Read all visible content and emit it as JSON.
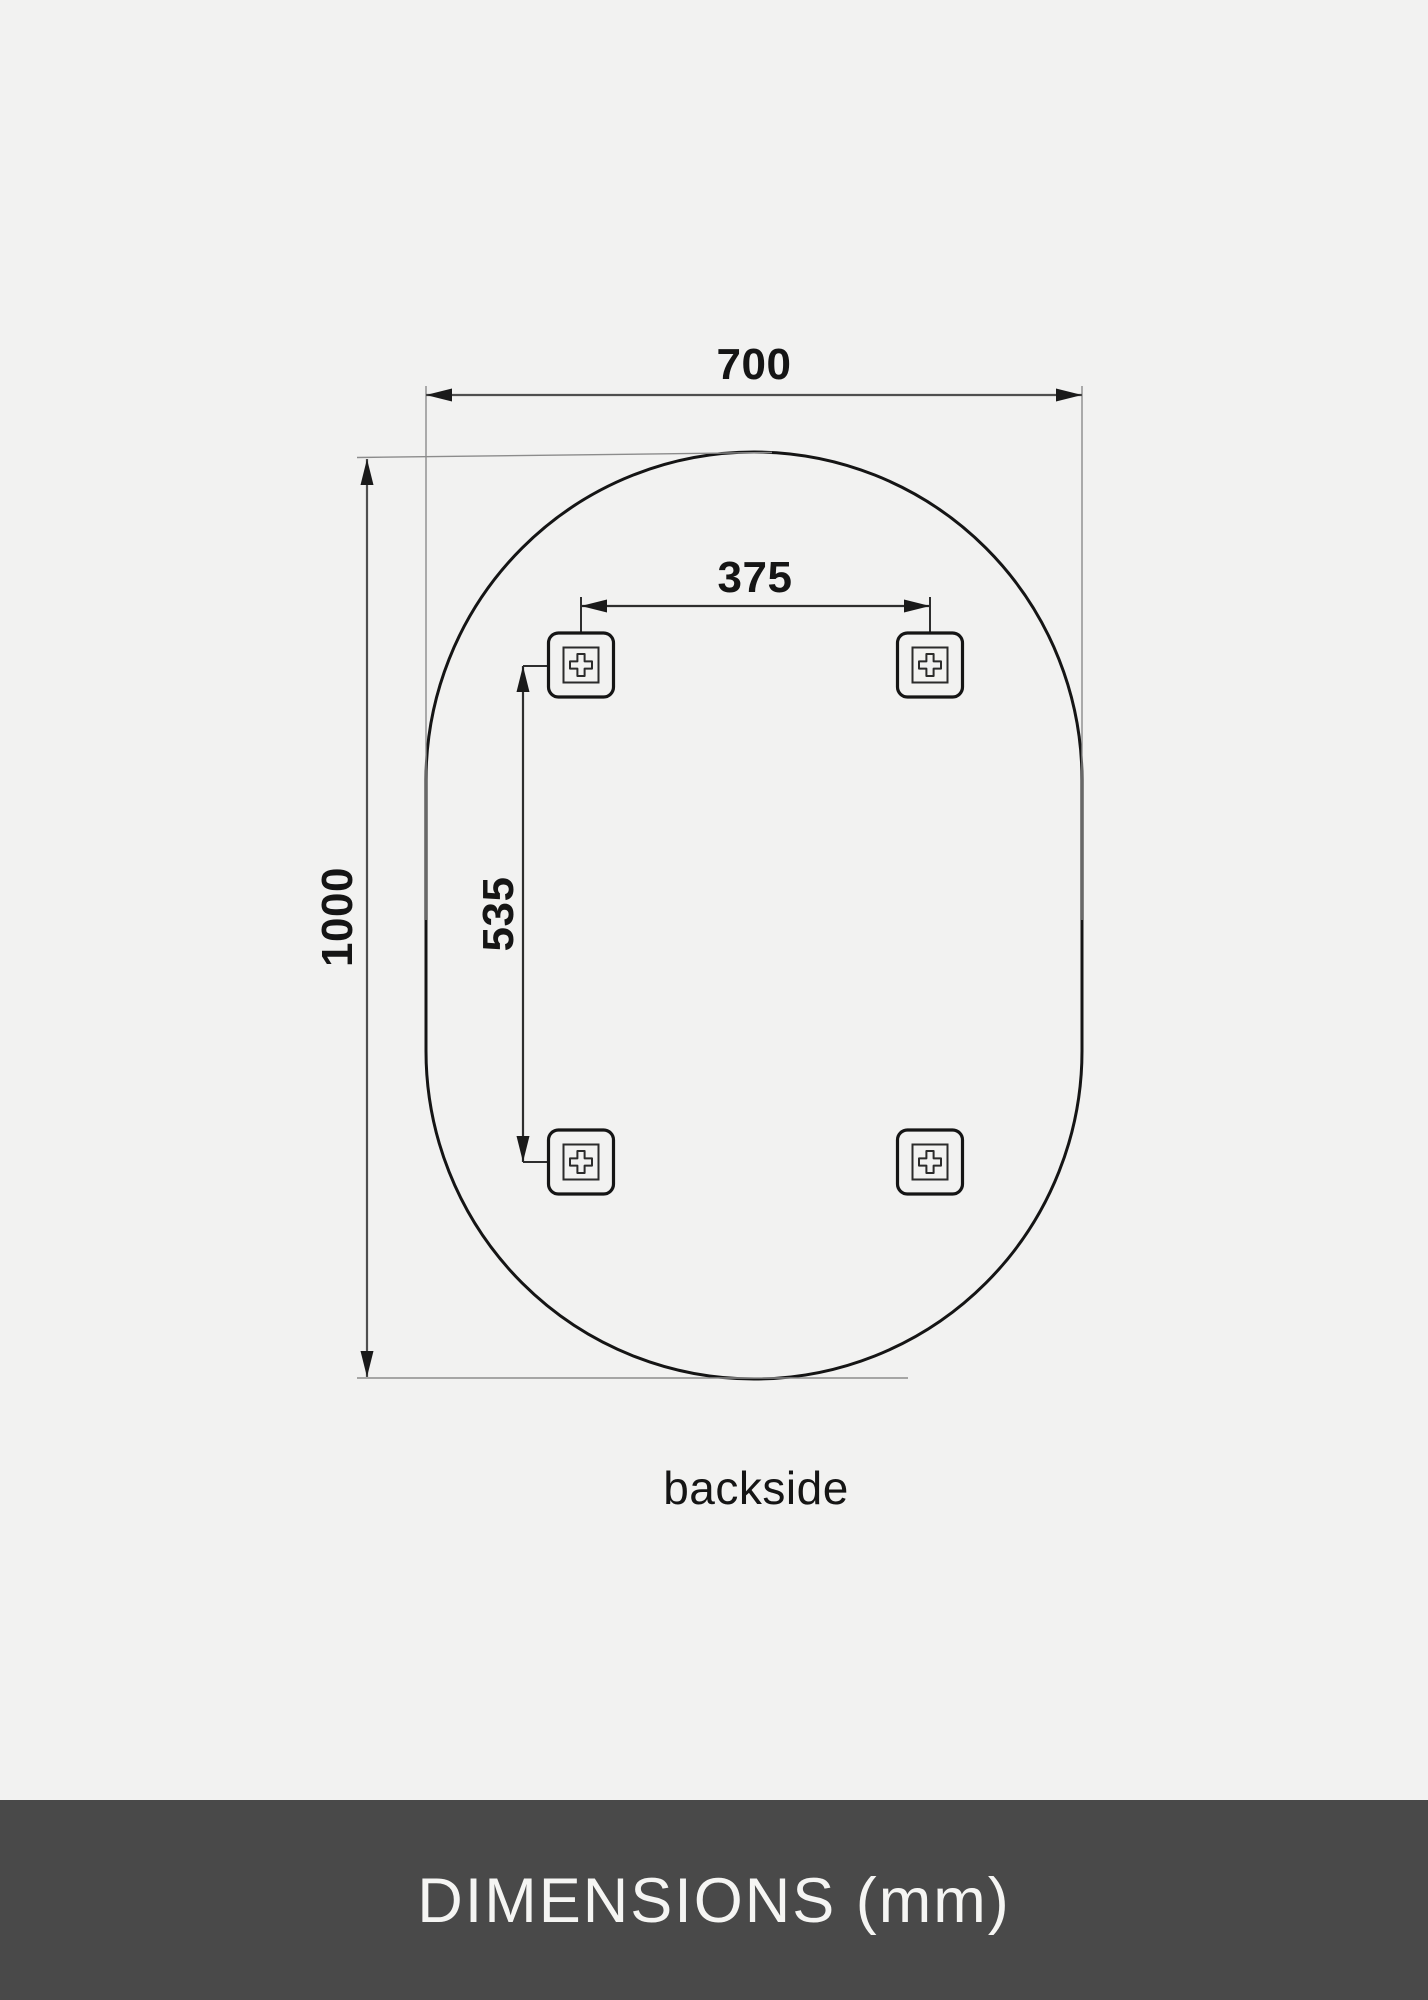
{
  "diagram": {
    "view_label": "backside",
    "dimensions": [
      {
        "name": "overall-width",
        "value": "700"
      },
      {
        "name": "overall-height",
        "value": "1000"
      },
      {
        "name": "bracket-spacing-horizontal",
        "value": "375"
      },
      {
        "name": "bracket-spacing-vertical",
        "value": "535"
      }
    ],
    "brackets": {
      "count": 4,
      "icon": "screw-cross-icon"
    }
  },
  "footer": {
    "title": "DIMENSIONS (mm)"
  },
  "colors": {
    "background": "#f2f2f1",
    "outline": "#151515",
    "dimension_line": "#4f4f4f",
    "extension_line": "#8c8c8c",
    "footer_background": "#494949",
    "footer_text": "#f5f5f3"
  }
}
